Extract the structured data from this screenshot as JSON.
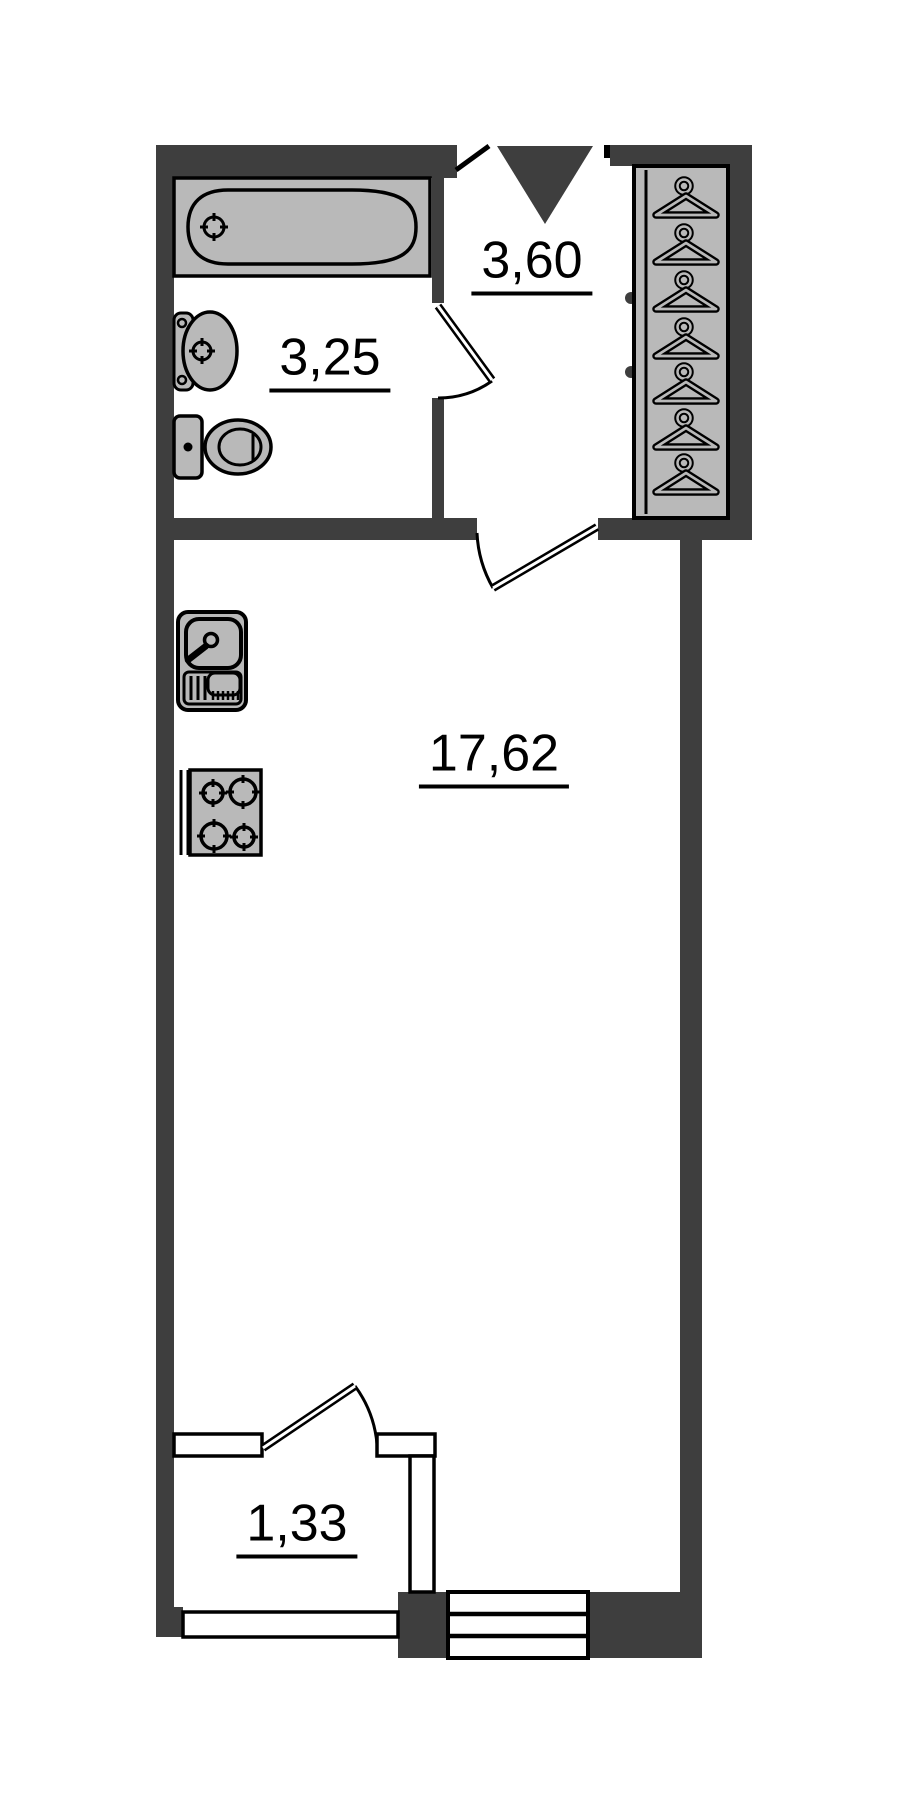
{
  "document": {
    "type": "floor-plan"
  },
  "colors": {
    "background": "#ffffff",
    "wall": "#3e3e3e",
    "fixture": "#b9b9b9",
    "outline": "#000000",
    "label": "#000000"
  },
  "rooms": [
    {
      "name": "bathroom",
      "area_label": "3,25"
    },
    {
      "name": "hallway",
      "area_label": "3,60"
    },
    {
      "name": "living-room",
      "area_label": "17,62"
    },
    {
      "name": "balcony",
      "area_label": "1,33"
    }
  ],
  "fixtures": [
    "entrance-arrow-icon",
    "wardrobe-hangers-icon",
    "bathtub-icon",
    "washbasin-icon",
    "toilet-icon",
    "kitchen-sink-icon",
    "stove-icon",
    "window-icon",
    "balcony-railing-icon",
    "door-swing-icon"
  ]
}
